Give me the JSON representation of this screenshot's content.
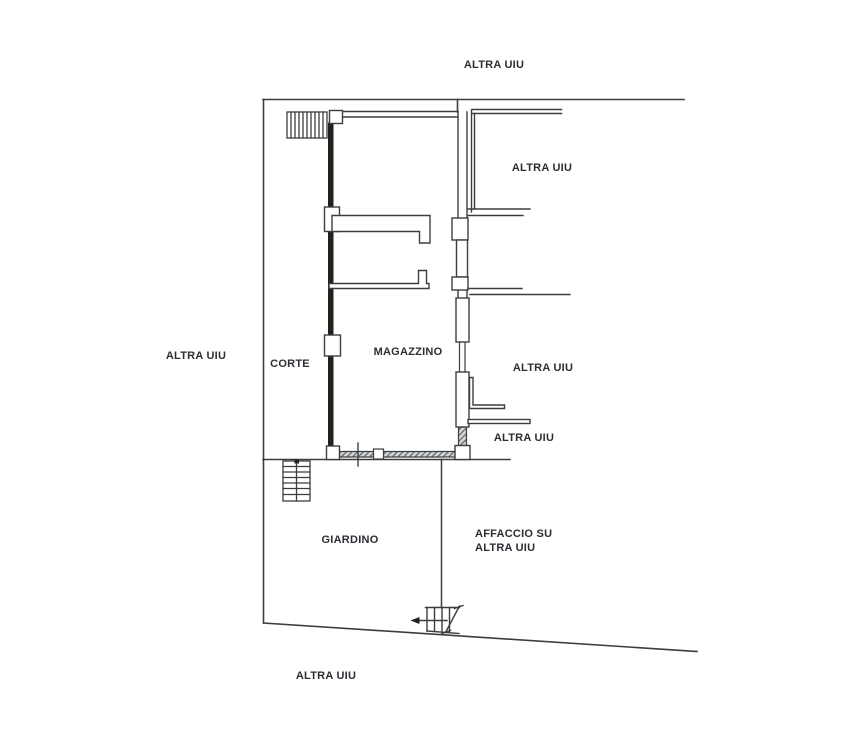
{
  "page": {
    "description": "Scanned cadastral floor plan (planimetria) showing a warehouse with courtyard and garden",
    "background": "#ffffff"
  },
  "colors": {
    "line": "#3b3e41",
    "dark_wall": "#20231b",
    "text": "#2b2e33",
    "background": "#ffffff"
  },
  "labels": {
    "altra_top": {
      "text": "ALTRA UIU"
    },
    "altra_upper_right": {
      "text": "ALTRA UIU"
    },
    "altra_left": {
      "text": "ALTRA UIU"
    },
    "corte": {
      "text": "CORTE"
    },
    "magazzino": {
      "text": "MAGAZZINO"
    },
    "altra_mid_right": {
      "text": "ALTRA UIU"
    },
    "altra_lower_right": {
      "text": "ALTRA UIU"
    },
    "giardino": {
      "text": "GIARDINO"
    },
    "affaccio_line1": {
      "text": "AFFACCIO SU"
    },
    "affaccio_line2": {
      "text": "ALTRA UIU"
    },
    "altra_bottom": {
      "text": "ALTRA UIU"
    }
  },
  "symbols": {
    "stairs_top_left": "stairs-hatch-icon",
    "stairs_courtyard": "stairs-flight-up-icon",
    "stairs_bottom_entry": "stairs-entry-arrow-icon"
  }
}
